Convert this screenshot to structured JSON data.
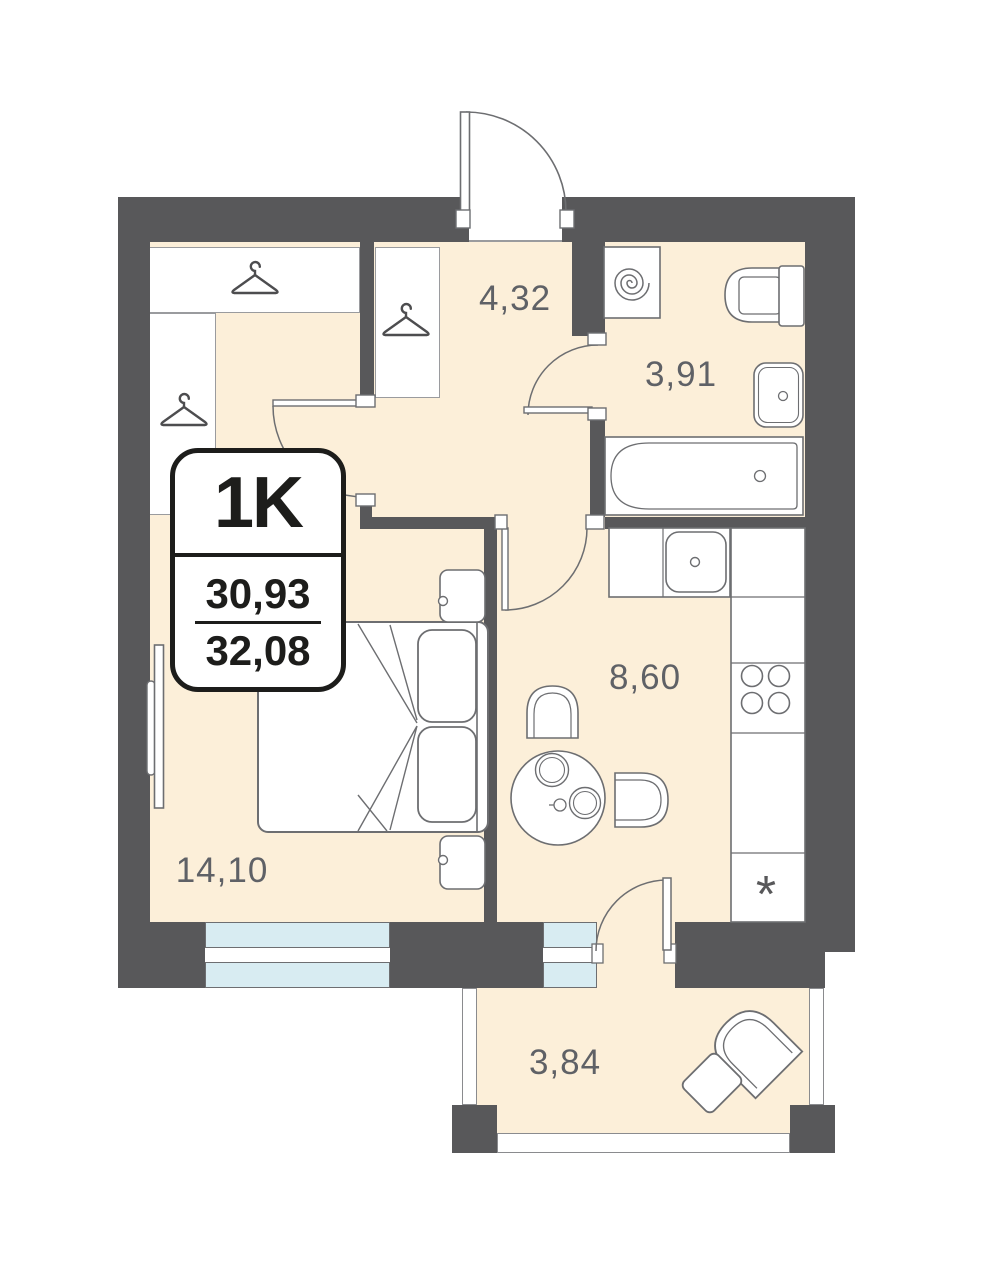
{
  "plan": {
    "badge": {
      "type_label": "1K",
      "area_living": "30,93",
      "area_total": "32,08"
    },
    "rooms": [
      {
        "name": "hallway",
        "area": "4,32"
      },
      {
        "name": "bathroom",
        "area": "3,91"
      },
      {
        "name": "kitchen",
        "area": "8,60"
      },
      {
        "name": "living-room",
        "area": "14,10"
      },
      {
        "name": "balcony",
        "area": "3,84"
      }
    ],
    "kitchen": {
      "fridge_symbol": "*"
    },
    "colors": {
      "wall": "#58585A",
      "floor": "#FCEFD9",
      "window_glass": "#D8ECF2",
      "outline": "#6d6e71",
      "badge_border": "#1d1d1b",
      "label_text": "#5f6166"
    },
    "icons": [
      "hanger-icon",
      "washing-machine-spiral-icon",
      "toilet-icon",
      "bathroom-sink-icon",
      "bathtub-icon",
      "kitchen-sink-icon",
      "hob-icon",
      "fridge-asterisk-icon",
      "double-bed-icon",
      "dining-table-icon",
      "armchair-icon",
      "door-swing-icon"
    ]
  }
}
